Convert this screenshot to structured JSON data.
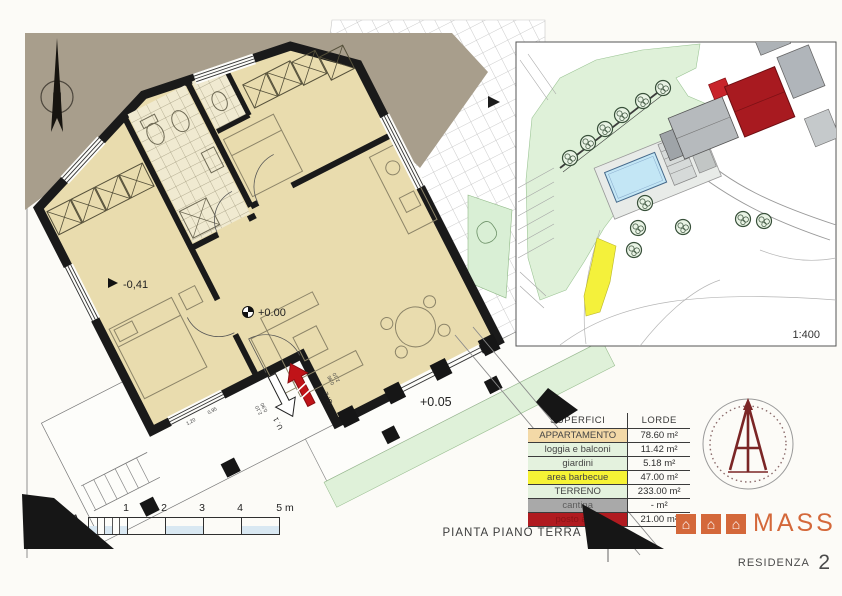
{
  "sheet": {
    "plan_title": "PIANTA PIANO TERRA",
    "residence_label": "RESIDENZA",
    "residence_number": "2"
  },
  "plan": {
    "north_label": "N",
    "levels": {
      "bedroom": "-0,41",
      "living": "+0.00",
      "terrace": "+0.05"
    },
    "entrances": [
      {
        "label": "U. 1"
      },
      {
        "label": "U. 2"
      }
    ],
    "door_dims": [
      "0,90",
      "2,10",
      "0,95",
      "2,10"
    ],
    "window_dims": [
      "1,20",
      "0,95"
    ]
  },
  "scalebar": {
    "label": "PIANTA",
    "scale_prefix": "1:",
    "ticks": [
      "1",
      "2",
      "3",
      "4"
    ],
    "end_label": "5 m"
  },
  "siteplan": {
    "scale_label": "1:400"
  },
  "surfaces_table": {
    "headers": [
      "SUPERFICI",
      "LORDE"
    ],
    "rows": [
      {
        "label": "APPARTAMENTO",
        "value": "78.60 m²",
        "bg": "#f3d9a7",
        "fg": "#454545"
      },
      {
        "label": "loggia e balconi",
        "value": "11.42 m²",
        "bg": "#e4f2de",
        "fg": "#454545"
      },
      {
        "label": "giardini",
        "value": "5.18 m²",
        "bg": "#e4f2de",
        "fg": "#454545"
      },
      {
        "label": "area barbecue",
        "value": "47.00 m²",
        "bg": "#f6f335",
        "fg": "#454545"
      },
      {
        "label": "TERRENO",
        "value": "233.00 m²",
        "bg": "#e4f2de",
        "fg": "#454545"
      },
      {
        "label": "cantina",
        "value": "- m²",
        "bg": "#a9a9a9",
        "fg": "#5d5d5d"
      },
      {
        "label": "posto auto",
        "value": "21.00 m²",
        "bg": "#b01b20",
        "fg": "#8c1216"
      }
    ]
  },
  "logo": {
    "brand": "MASS",
    "house_glyph": "⌂"
  },
  "colors": {
    "apartment_fill": "#e9dcae",
    "wall_black": "#1a1a1a",
    "terrain_green": "#dff1d9",
    "barbecue_yellow": "#f4f13b",
    "residence_red": "#a81a20",
    "logo_orange": "#d4683a",
    "pool_blue": "#c3e6f5",
    "ground_taupe": "#a89e8c"
  }
}
